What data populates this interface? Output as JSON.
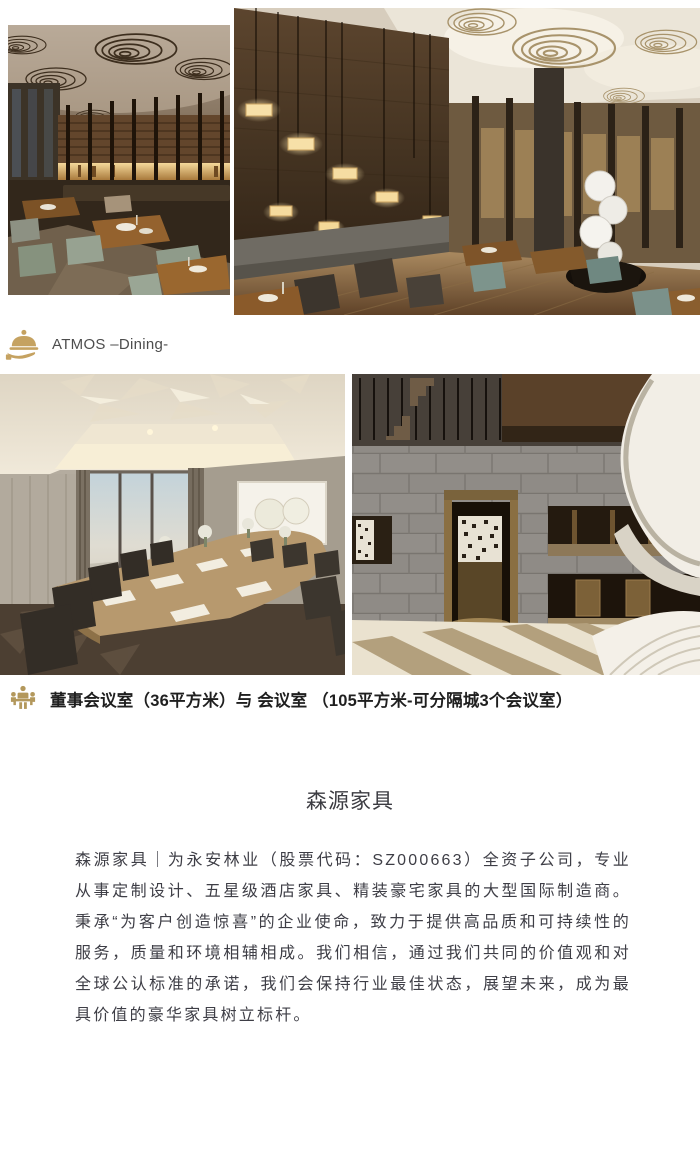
{
  "captions": {
    "dining": {
      "label": "ATMOS –Dining-"
    },
    "meeting": {
      "label": "董事会议室（36平方米）与 会议室 （105平方米-可分隔城3个会议室）"
    }
  },
  "article": {
    "title": "森源家具",
    "paragraph": "森源家具｜为永安林业（股票代码：SZ000663）全资子公司，专业从事定制设计、五星级酒店家具、精装豪宅家具的大型国际制造商。秉承“为客户创造惊喜”的企业使命，致力于提供高品质和可持续性的服务，质量和环境相辅相成。我们相信，通过我们共同的价值观和对全球公认标准的承诺，我们会保持行业最佳状态，展望未来，成为最具价值的豪华家具树立标杆。"
  },
  "colors": {
    "accent_gold": "#c5a261",
    "caption_text": "#4d4d4d",
    "caption_bold_text": "#1f1f1f",
    "body_text": "#3e3e46"
  }
}
